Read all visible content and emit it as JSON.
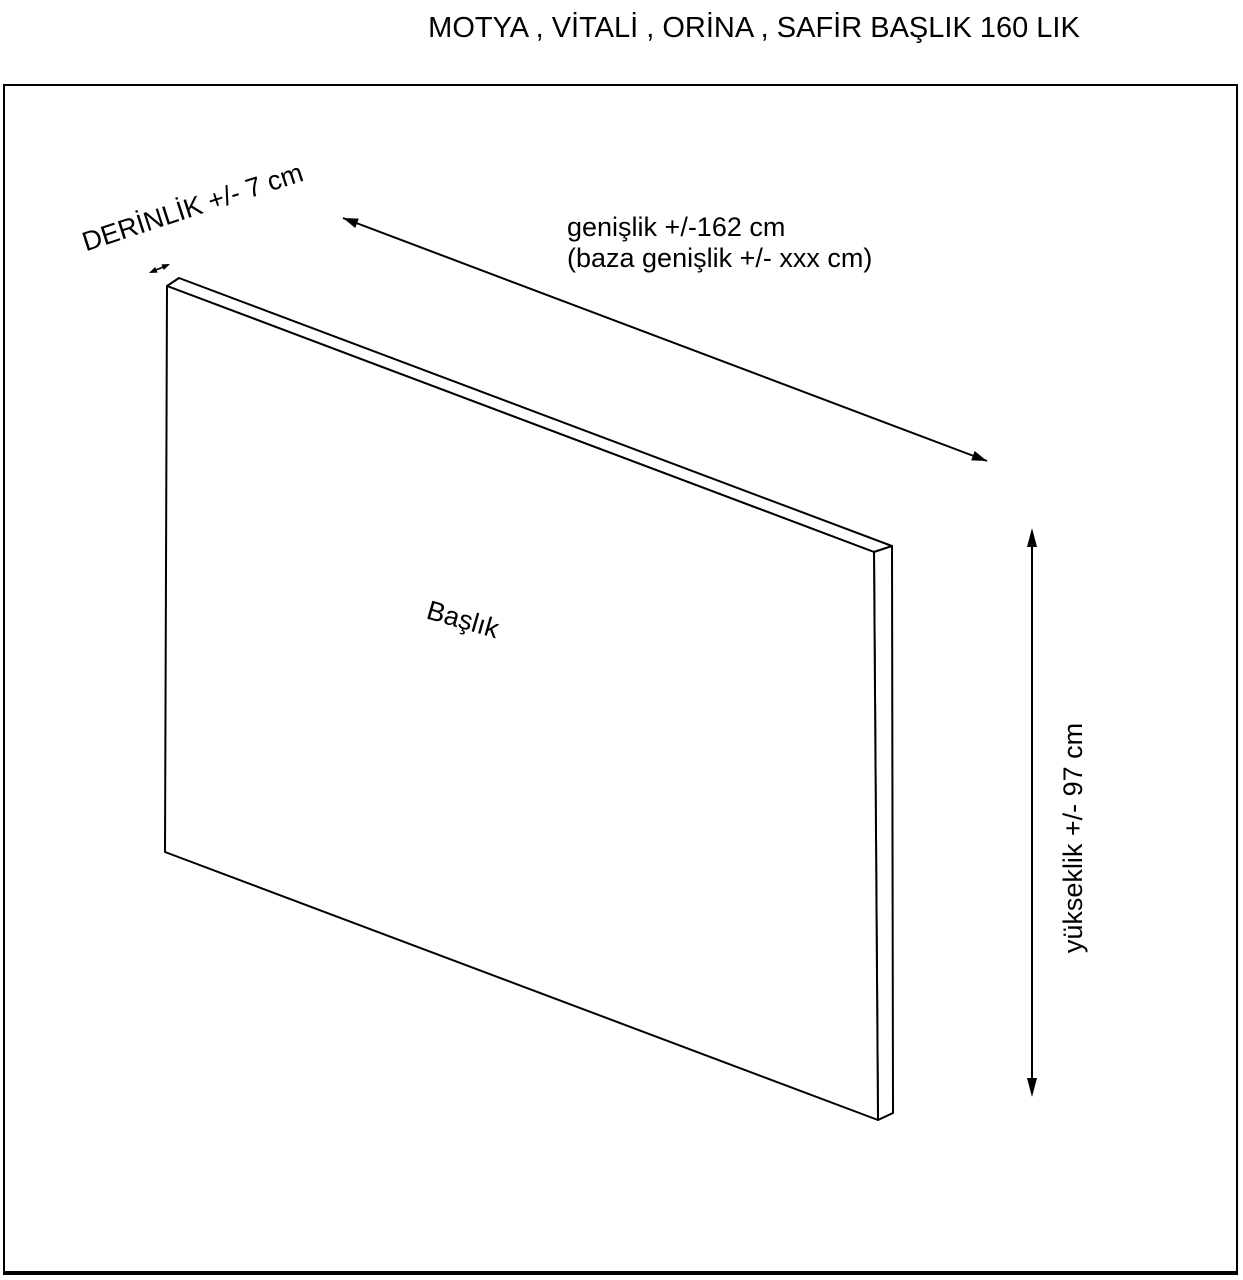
{
  "title": "MOTYA , VİTALİ , ORİNA , SAFİR BAŞLIK 160 LIK",
  "drawing": {
    "part_label": "Başlık",
    "depth_label": "DERİNLİK +/- 7 cm",
    "width_label_line1": "genişlik +/-162 cm",
    "width_label_line2": "(baza genişlik +/- xxx cm)",
    "height_label": "yükseklik +/- 97 cm",
    "arrows": [
      "depth-arrow",
      "width-arrow",
      "height-arrow"
    ]
  },
  "colors": {
    "line": "#000000",
    "background": "#ffffff"
  }
}
